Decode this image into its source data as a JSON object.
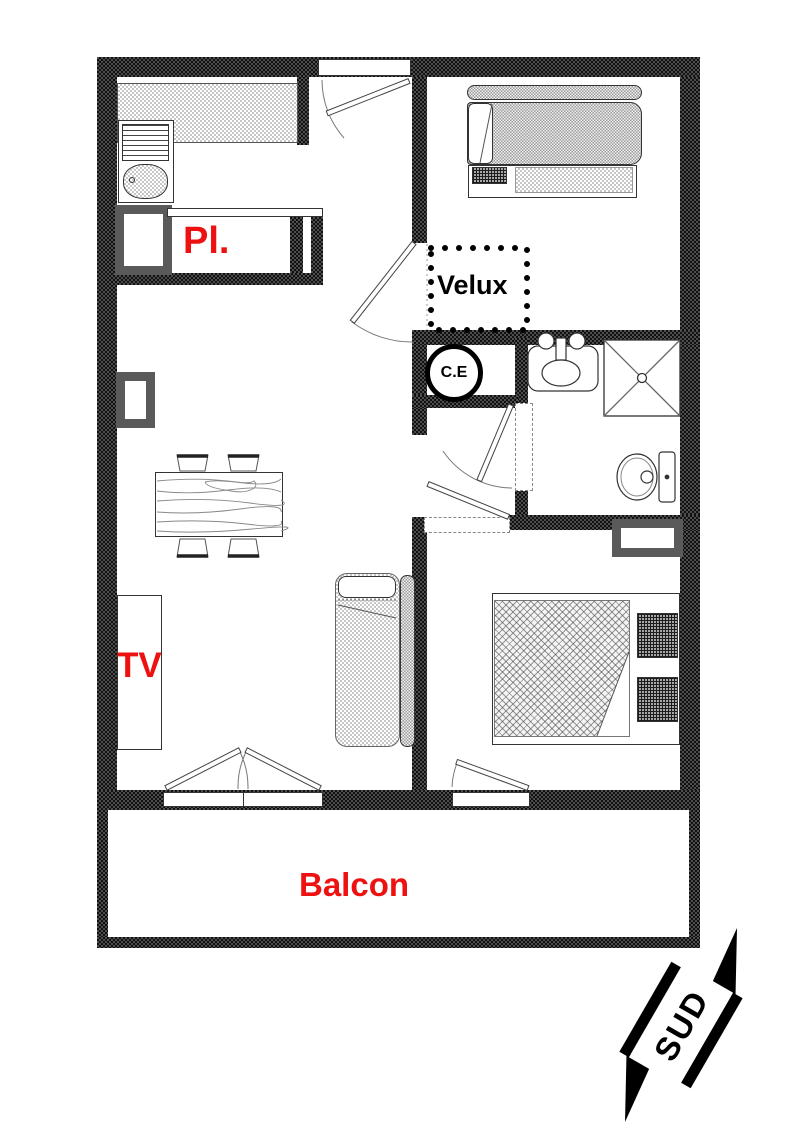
{
  "plan": {
    "labels": {
      "closet": "Pl.",
      "roof_window": "Velux",
      "water_heater": "C.E",
      "tv": "TV",
      "balcony": "Balcon",
      "compass_south": "SUD"
    },
    "colors": {
      "label_red": "#ee1111",
      "wall_dark": "#111111",
      "wall_gray": "#4d4d4d",
      "radiator_gray": "#5a5a5a"
    }
  }
}
